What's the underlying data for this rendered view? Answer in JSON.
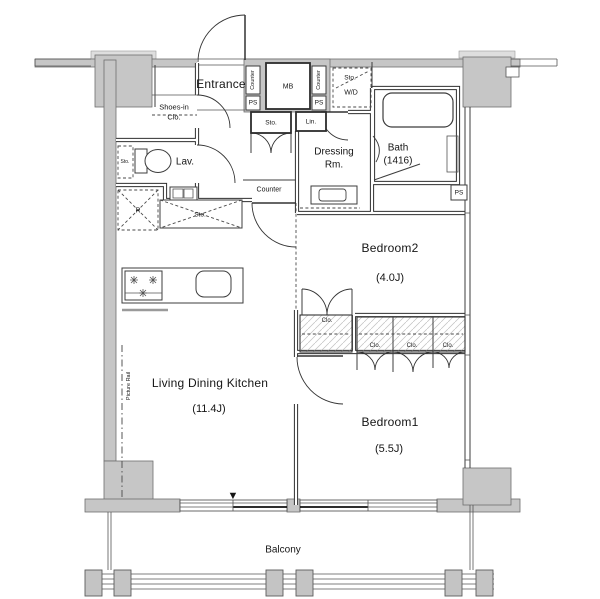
{
  "rooms": {
    "entrance": "Entrance",
    "shoes_in_closet_line1": "Shoes-in",
    "shoes_in_closet_line2": "Clo.",
    "lavatory": "Lav.",
    "dressing_room_line1": "Dressing",
    "dressing_room_line2": "Rm.",
    "bath_line1": "Bath",
    "bath_line2": "(1416)",
    "bedroom2_name": "Bedroom2",
    "bedroom2_size": "(4.0J)",
    "bedroom1_name": "Bedroom1",
    "bedroom1_size": "(5.5J)",
    "ldk_name": "Living Dining Kitchen",
    "ldk_size": "(11.4J)",
    "balcony": "Balcony"
  },
  "labels": {
    "storage": "Sto.",
    "closet": "Clo.",
    "linen": "Lin.",
    "pipe_space": "PS",
    "meter_box": "MB",
    "washer_dryer": "W/D",
    "counter": "Counter",
    "refrigerator": "R",
    "picture_rail": "Picture Rail",
    "marker_down": "▼"
  }
}
